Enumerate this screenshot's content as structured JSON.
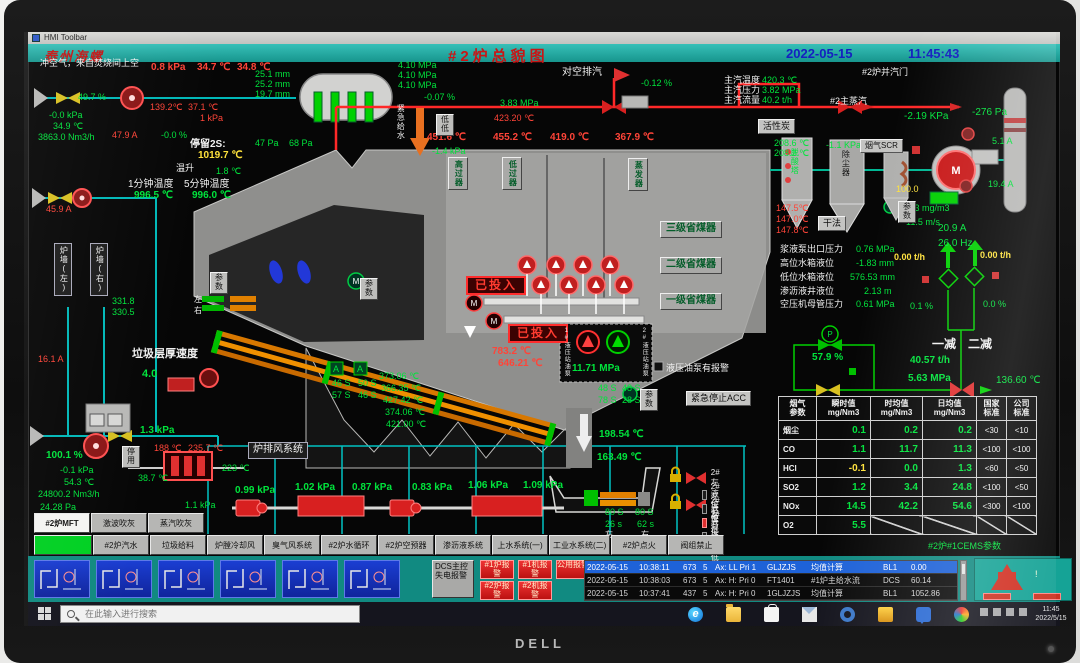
{
  "colors": {
    "green": "#00e43c",
    "red": "#ff4438",
    "yellow": "#ffe23c",
    "teal": "#17958d",
    "blue": "#1520c0",
    "orange": "#e88a10"
  },
  "monitor": {
    "brand": "DELL"
  },
  "window": {
    "title": "HMI  Toolbar"
  },
  "header": {
    "logo": "泰州海螺",
    "title": "#2炉总貌图",
    "date": "2022-05-15",
    "time": "11:45:43"
  },
  "icons": {
    "motor_letter": "M",
    "grate_letter": "A",
    "pump_letter": "P",
    "edge_glyph": "e",
    "alarm_exclaim": "!"
  },
  "annotations": [
    {
      "n": "purge-air-label",
      "t": "冲空气，来自焚烧间上空",
      "x": 36,
      "y": 59,
      "c": "w"
    },
    {
      "n": "purge-air-pressure",
      "t": "0.8 kPa",
      "x": 147,
      "y": 63,
      "c": "r",
      "s": 10,
      "w": 1
    },
    {
      "t": "34.7 ℃",
      "x": 193,
      "y": 63,
      "c": "r",
      "s": 10,
      "w": 1
    },
    {
      "t": "34.8 ℃",
      "x": 233,
      "y": 63,
      "c": "r",
      "s": 10,
      "w": 1
    },
    {
      "n": "drum-level-1",
      "t": "25.1 mm",
      "x": 251,
      "y": 70,
      "c": "g"
    },
    {
      "n": "drum-level-2",
      "t": "25.2 mm",
      "x": 251,
      "y": 80,
      "c": "g"
    },
    {
      "n": "drum-level-3",
      "t": "19.7 mm",
      "x": 251,
      "y": 90,
      "c": "g"
    },
    {
      "t": "49.7 %",
      "x": 74,
      "y": 93,
      "c": "g"
    },
    {
      "t": "-0.0 kPa",
      "x": 45,
      "y": 111,
      "c": "g"
    },
    {
      "t": "34.9 ℃",
      "x": 49,
      "y": 122,
      "c": "g"
    },
    {
      "t": "3863.0 Nm3/h",
      "x": 34,
      "y": 133,
      "c": "g"
    },
    {
      "t": "139.2℃",
      "x": 146,
      "y": 103,
      "c": "r"
    },
    {
      "t": "37.1 ℃",
      "x": 184,
      "y": 103,
      "c": "r"
    },
    {
      "t": "1 kPa",
      "x": 196,
      "y": 114,
      "c": "r"
    },
    {
      "t": "47.9 A",
      "x": 108,
      "y": 131,
      "c": "r"
    },
    {
      "t": "-0.0 %",
      "x": 157,
      "y": 131,
      "c": "g"
    },
    {
      "n": "residence-label",
      "t": "停留2S:",
      "x": 186,
      "y": 140,
      "c": "w",
      "s": 10,
      "w": 1
    },
    {
      "n": "residence-temp",
      "t": "1019.7 ℃",
      "x": 194,
      "y": 151,
      "c": "y",
      "s": 10,
      "w": 1
    },
    {
      "t": "温升",
      "x": 172,
      "y": 164,
      "c": "w"
    },
    {
      "t": "1.8 ℃",
      "x": 212,
      "y": 167,
      "c": "g"
    },
    {
      "t": "1分钟温度",
      "x": 124,
      "y": 180,
      "c": "w",
      "s": 10
    },
    {
      "t": "5分钟温度",
      "x": 180,
      "y": 180,
      "c": "w",
      "s": 10
    },
    {
      "t": "996.5 ℃",
      "x": 130,
      "y": 191,
      "c": "g",
      "s": 10,
      "w": 1
    },
    {
      "t": "996.0 ℃",
      "x": 188,
      "y": 191,
      "c": "g",
      "s": 10,
      "w": 1
    },
    {
      "t": "45.9 A",
      "x": 42,
      "y": 205,
      "c": "r"
    },
    {
      "t": "16.1 A",
      "x": 34,
      "y": 355,
      "c": "r"
    },
    {
      "t": "331.8",
      "x": 108,
      "y": 297,
      "c": "g"
    },
    {
      "t": "330.5",
      "x": 108,
      "y": 308,
      "c": "g"
    },
    {
      "t": "左",
      "x": 190,
      "y": 296,
      "c": "w",
      "s": 8
    },
    {
      "t": "右",
      "x": 190,
      "y": 307,
      "c": "w",
      "s": 8
    },
    {
      "n": "drum-pressure-1",
      "t": "4.10 MPa",
      "x": 394,
      "y": 61,
      "c": "g"
    },
    {
      "t": "4.10 MPa",
      "x": 394,
      "y": 71,
      "c": "g"
    },
    {
      "t": "4.10 MPa",
      "x": 394,
      "y": 81,
      "c": "g"
    },
    {
      "t": "-0.07 %",
      "x": 420,
      "y": 93,
      "c": "g"
    },
    {
      "t": "3.83 MPa",
      "x": 496,
      "y": 99,
      "c": "g"
    },
    {
      "t": "423.20 ℃",
      "x": 490,
      "y": 114,
      "c": "r"
    },
    {
      "n": "vent-label",
      "t": "对空排汽",
      "x": 558,
      "y": 68,
      "c": "w",
      "s": 10
    },
    {
      "t": "-0.12 %",
      "x": 637,
      "y": 79,
      "c": "g"
    },
    {
      "t": "主汽温度",
      "x": 720,
      "y": 76,
      "c": "w"
    },
    {
      "t": "主汽压力",
      "x": 720,
      "y": 86,
      "c": "w"
    },
    {
      "t": "主汽流量",
      "x": 720,
      "y": 96,
      "c": "w"
    },
    {
      "n": "main-steam-temp",
      "t": "420.3 ℃",
      "x": 758,
      "y": 76,
      "c": "g"
    },
    {
      "n": "main-steam-pressure",
      "t": "3.82 MPa",
      "x": 758,
      "y": 86,
      "c": "g"
    },
    {
      "n": "main-steam-flow",
      "t": "40.2 t/h",
      "x": 758,
      "y": 96,
      "c": "g"
    },
    {
      "t": "#2主蒸汽",
      "x": 826,
      "y": 97,
      "c": "w"
    },
    {
      "t": "#2炉并汽门",
      "x": 858,
      "y": 68,
      "c": "w"
    },
    {
      "t": "-2.19 KPa",
      "x": 900,
      "y": 112,
      "c": "g",
      "s": 10
    },
    {
      "t": "-276 Pa",
      "x": 968,
      "y": 108,
      "c": "g",
      "s": 10
    },
    {
      "t": "47 Pa",
      "x": 251,
      "y": 139,
      "c": "g"
    },
    {
      "t": "68 Pa",
      "x": 285,
      "y": 139,
      "c": "g"
    },
    {
      "t": "451.6 ℃",
      "x": 423,
      "y": 133,
      "c": "r",
      "s": 10,
      "w": 1
    },
    {
      "t": "-1.4 kPa",
      "x": 428,
      "y": 147,
      "c": "g"
    },
    {
      "t": "455.2 ℃",
      "x": 489,
      "y": 133,
      "c": "r",
      "s": 10,
      "w": 1
    },
    {
      "t": "419.0 ℃",
      "x": 546,
      "y": 133,
      "c": "r",
      "s": 10,
      "w": 1
    },
    {
      "t": "367.9 ℃",
      "x": 611,
      "y": 133,
      "c": "r",
      "s": 10,
      "w": 1
    },
    {
      "n": "emergency-feedwater",
      "t": "紧急给水",
      "x": 392,
      "y": 104,
      "c": "w",
      "v": 1,
      "s": 8
    },
    {
      "t": "208.6 ℃",
      "x": 770,
      "y": 139,
      "c": "g"
    },
    {
      "t": "208.2 ℃",
      "x": 770,
      "y": 149,
      "c": "g"
    },
    {
      "t": "-1.1 KPa",
      "x": 822,
      "y": 141,
      "c": "g"
    },
    {
      "t": "147.5℃",
      "x": 772,
      "y": 204,
      "c": "r"
    },
    {
      "t": "147.0℃",
      "x": 772,
      "y": 215,
      "c": "r"
    },
    {
      "t": "147.8℃",
      "x": 772,
      "y": 226,
      "c": "r"
    },
    {
      "t": "93.3 mg/m3",
      "x": 898,
      "y": 204,
      "c": "g"
    },
    {
      "t": "11.5 m/s",
      "x": 902,
      "y": 218,
      "c": "g"
    },
    {
      "t": "100.0",
      "x": 892,
      "y": 185,
      "c": "y"
    },
    {
      "t": "20.9 A",
      "x": 934,
      "y": 224,
      "c": "g",
      "s": 10
    },
    {
      "t": "26.0 Hz",
      "x": 934,
      "y": 239,
      "c": "g",
      "s": 10
    },
    {
      "t": "5.1 A",
      "x": 988,
      "y": 137,
      "c": "g"
    },
    {
      "t": "19.4 A",
      "x": 984,
      "y": 180,
      "c": "g"
    },
    {
      "t": "浆液泵出口压力",
      "x": 776,
      "y": 245,
      "c": "w"
    },
    {
      "t": "0.76 MPa",
      "x": 852,
      "y": 245,
      "c": "g"
    },
    {
      "t": "高位水箱液位",
      "x": 776,
      "y": 259,
      "c": "w"
    },
    {
      "t": "-1.83 mm",
      "x": 852,
      "y": 259,
      "c": "g"
    },
    {
      "t": "低位水箱液位",
      "x": 776,
      "y": 273,
      "c": "w"
    },
    {
      "t": "576.53 mm",
      "x": 846,
      "y": 273,
      "c": "g"
    },
    {
      "t": "渗沥液井液位",
      "x": 776,
      "y": 287,
      "c": "w"
    },
    {
      "t": "2.13 m",
      "x": 860,
      "y": 287,
      "c": "g"
    },
    {
      "t": "空压机母管压力",
      "x": 776,
      "y": 300,
      "c": "w"
    },
    {
      "t": "0.61 MPa",
      "x": 852,
      "y": 300,
      "c": "g"
    },
    {
      "t": "0.00 t/h",
      "x": 890,
      "y": 253,
      "c": "y",
      "w": 1
    },
    {
      "t": "0.00 t/h",
      "x": 976,
      "y": 251,
      "c": "y",
      "w": 1
    },
    {
      "t": "0.1 %",
      "x": 906,
      "y": 302,
      "c": "g"
    },
    {
      "t": "0.0 %",
      "x": 979,
      "y": 300,
      "c": "g"
    },
    {
      "t": "一减",
      "x": 928,
      "y": 338,
      "c": "w",
      "s": 12,
      "w": 1
    },
    {
      "t": "二减",
      "x": 964,
      "y": 338,
      "c": "w",
      "s": 12,
      "w": 1
    },
    {
      "t": "57.9 %",
      "x": 808,
      "y": 353,
      "c": "g",
      "s": 10,
      "w": 1
    },
    {
      "t": "40.57 t/h",
      "x": 906,
      "y": 356,
      "c": "g",
      "s": 10,
      "w": 1
    },
    {
      "t": "5.63 MPa",
      "x": 904,
      "y": 374,
      "c": "g",
      "s": 10,
      "w": 1
    },
    {
      "t": "136.60 ℃",
      "x": 992,
      "y": 376,
      "c": "g",
      "s": 10
    },
    {
      "t": "783.2 ℃",
      "x": 488,
      "y": 347,
      "c": "r",
      "s": 10,
      "w": 1
    },
    {
      "t": "646.21 ℃",
      "x": 494,
      "y": 359,
      "c": "r",
      "s": 10,
      "w": 1
    },
    {
      "t": "11.71 MPa",
      "x": 568,
      "y": 364,
      "c": "g",
      "s": 10,
      "w": 1
    },
    {
      "n": "hyd-alarm-label",
      "t": "液压油泵有报警",
      "x": 662,
      "y": 364,
      "c": "w"
    },
    {
      "n": "waste-layer-label",
      "t": "垃圾层厚速度",
      "x": 128,
      "y": 349,
      "c": "w",
      "s": 11,
      "w": 1
    },
    {
      "t": "4.0",
      "x": 138,
      "y": 369,
      "c": "g",
      "s": 11,
      "w": 1
    },
    {
      "t": "373.06 ℃",
      "x": 375,
      "y": 372,
      "c": "g"
    },
    {
      "t": "366.35 ℃",
      "x": 377,
      "y": 384,
      "c": "g"
    },
    {
      "t": "427.42 ℃",
      "x": 379,
      "y": 396,
      "c": "g"
    },
    {
      "t": "374.06 ℃",
      "x": 381,
      "y": 408,
      "c": "g"
    },
    {
      "t": "421.00 ℃",
      "x": 382,
      "y": 420,
      "c": "g"
    },
    {
      "t": "46 S",
      "x": 328,
      "y": 379,
      "c": "g"
    },
    {
      "t": "50 S",
      "x": 354,
      "y": 379,
      "c": "g"
    },
    {
      "t": "57 S",
      "x": 328,
      "y": 391,
      "c": "g"
    },
    {
      "t": "46 S",
      "x": 354,
      "y": 391,
      "c": "g"
    },
    {
      "t": "48 S",
      "x": 594,
      "y": 384,
      "c": "g"
    },
    {
      "t": "48 S",
      "x": 618,
      "y": 384,
      "c": "g"
    },
    {
      "t": "78 S",
      "x": 594,
      "y": 396,
      "c": "g"
    },
    {
      "t": "28 S",
      "x": 618,
      "y": 396,
      "c": "g"
    },
    {
      "t": "1.3 kPa",
      "x": 136,
      "y": 426,
      "c": "g",
      "s": 10,
      "w": 1
    },
    {
      "t": "188 ℃",
      "x": 150,
      "y": 444,
      "c": "r"
    },
    {
      "t": "235.7 ℃",
      "x": 184,
      "y": 444,
      "c": "r"
    },
    {
      "t": "38.7 ℃",
      "x": 134,
      "y": 474,
      "c": "g"
    },
    {
      "t": "223 ℃",
      "x": 218,
      "y": 464,
      "c": "g"
    },
    {
      "t": "100.1 %",
      "x": 42,
      "y": 451,
      "c": "g",
      "s": 10,
      "w": 1
    },
    {
      "t": "-0.1 kPa",
      "x": 56,
      "y": 466,
      "c": "g"
    },
    {
      "t": "54.3 ℃",
      "x": 60,
      "y": 478,
      "c": "g"
    },
    {
      "t": "24800.2 Nm3/h",
      "x": 34,
      "y": 490,
      "c": "g"
    },
    {
      "t": "24.28 Pa",
      "x": 36,
      "y": 503,
      "c": "g"
    },
    {
      "t": "0.99 kPa",
      "x": 231,
      "y": 486,
      "c": "g",
      "s": 10,
      "w": 1
    },
    {
      "t": "1.02 kPa",
      "x": 291,
      "y": 483,
      "c": "g",
      "s": 10,
      "w": 1
    },
    {
      "t": "0.87 kPa",
      "x": 348,
      "y": 483,
      "c": "g",
      "s": 10,
      "w": 1
    },
    {
      "t": "0.83 kPa",
      "x": 408,
      "y": 483,
      "c": "g",
      "s": 10,
      "w": 1
    },
    {
      "t": "1.06 kPa",
      "x": 464,
      "y": 481,
      "c": "g",
      "s": 10,
      "w": 1
    },
    {
      "t": "1.09 kPa",
      "x": 519,
      "y": 481,
      "c": "g",
      "s": 10,
      "w": 1
    },
    {
      "t": "1.1 kPa",
      "x": 181,
      "y": 501,
      "c": "g"
    },
    {
      "t": "198.54 ℃",
      "x": 595,
      "y": 430,
      "c": "g",
      "s": 10,
      "w": 1
    },
    {
      "t": "163.49 ℃",
      "x": 593,
      "y": 453,
      "c": "g",
      "s": 10,
      "w": 1
    },
    {
      "t": "80 S",
      "x": 601,
      "y": 508,
      "c": "g"
    },
    {
      "t": "80 S",
      "x": 631,
      "y": 508,
      "c": "g"
    },
    {
      "t": "26 s",
      "x": 601,
      "y": 520,
      "c": "g"
    },
    {
      "t": "62 s",
      "x": 633,
      "y": 520,
      "c": "g"
    },
    {
      "t": "左",
      "x": 601,
      "y": 531,
      "c": "w",
      "s": 8
    },
    {
      "t": "右",
      "x": 637,
      "y": 531,
      "c": "w",
      "s": 8
    },
    {
      "n": "cems-caption",
      "t": "#2炉#1CEMS参数",
      "x": 924,
      "y": 542,
      "c": "g"
    },
    {
      "n": "committed-1",
      "t": "已投入",
      "x": 462,
      "y": 276,
      "bx": "red"
    },
    {
      "n": "committed-2",
      "t": "已投入",
      "x": 504,
      "y": 324,
      "bx": "red"
    },
    {
      "n": "activated-carbon-box",
      "t": "活性炭",
      "x": 754,
      "y": 119,
      "bx": "2"
    },
    {
      "n": "scr-box",
      "t": "烟气SCR",
      "x": 856,
      "y": 139,
      "bx": "2",
      "s": 8
    },
    {
      "n": "dry-method-box",
      "t": "干法",
      "x": 814,
      "y": 216,
      "bx": "2"
    },
    {
      "n": "economizer-3",
      "t": "三级省煤器",
      "x": 656,
      "y": 221,
      "bx": "3",
      "s": 10
    },
    {
      "n": "economizer-2",
      "t": "二级省煤器",
      "x": 656,
      "y": 257,
      "bx": "3",
      "s": 10
    },
    {
      "n": "economizer-1",
      "t": "一级省煤器",
      "x": 656,
      "y": 293,
      "bx": "3",
      "s": 10
    },
    {
      "n": "grate-fan-system-box",
      "t": "炉排风系统",
      "x": 244,
      "y": 442,
      "bx": "1",
      "s": 10
    },
    {
      "n": "acc-stop-box",
      "t": "紧急停止ACC",
      "x": 682,
      "y": 391,
      "bx": "2"
    },
    {
      "n": "furnace-wall-left",
      "t": "炉墙(左)",
      "x": 50,
      "y": 243,
      "bx": "1",
      "v": 1,
      "s": 8
    },
    {
      "n": "furnace-wall-right",
      "t": "炉墙(右)",
      "x": 86,
      "y": 243,
      "bx": "1",
      "v": 1,
      "s": 8
    },
    {
      "n": "hp-superheater",
      "t": "高过器",
      "x": 444,
      "y": 157,
      "bx": "3",
      "v": 1,
      "s": 8
    },
    {
      "n": "lp-superheater",
      "t": "低过器",
      "x": 498,
      "y": 157,
      "bx": "3",
      "v": 1,
      "s": 8
    },
    {
      "n": "evaporator",
      "t": "蒸发器",
      "x": 624,
      "y": 158,
      "bx": "3",
      "v": 1,
      "s": 8
    },
    {
      "n": "deacid-tower-label",
      "t": "脱酸塔",
      "x": 786,
      "y": 148,
      "c": "g",
      "v": 1,
      "s": 8
    },
    {
      "n": "baghouse-label",
      "t": "除尘器",
      "x": 837,
      "y": 150,
      "c": "k",
      "v": 1,
      "s": 8
    },
    {
      "n": "hyd-pump-1-label",
      "t": "1#液压站油泵",
      "x": 559,
      "y": 328,
      "c": "w",
      "v": 1,
      "s": 6
    },
    {
      "n": "hyd-pump-2-label",
      "t": "2#液压站油泵",
      "x": 637,
      "y": 328,
      "c": "w",
      "v": 1,
      "s": 6
    }
  ],
  "small_buttons": [
    {
      "n": "param-button-1",
      "t": "参数",
      "x": 206,
      "y": 272
    },
    {
      "n": "param-button-2",
      "t": "参数",
      "x": 356,
      "y": 278
    },
    {
      "n": "param-button-3",
      "t": "参数",
      "x": 636,
      "y": 389
    },
    {
      "n": "param-button-4",
      "t": "参数",
      "x": 894,
      "y": 201
    },
    {
      "n": "disabled-button",
      "t": "停用",
      "x": 118,
      "y": 446
    },
    {
      "n": "lowlow-button",
      "t": "低低",
      "x": 432,
      "y": 114
    }
  ],
  "menus": {
    "row1": [
      {
        "t": "#2炉MFT",
        "active": true
      },
      {
        "t": "激波吹灰"
      },
      {
        "t": "蒸汽吹灰"
      }
    ],
    "row2": [
      {
        "t": "",
        "green": true
      },
      {
        "t": "#2炉汽水"
      },
      {
        "t": "垃圾给料"
      },
      {
        "t": "炉膛冷却风"
      },
      {
        "t": "臭气风系统"
      },
      {
        "t": "#2炉水循环"
      },
      {
        "t": "#2炉空预器"
      },
      {
        "t": "渗沥液系统"
      },
      {
        "t": "上水系统(一)"
      },
      {
        "t": "工业水系统(二)"
      },
      {
        "t": "#2炉点火"
      },
      {
        "t": "阀组禁止"
      }
    ]
  },
  "level_switches": [
    {
      "t": "2#左液位高",
      "on": false
    },
    {
      "t": "2#左液位低",
      "on": false
    },
    {
      "t": "2#右液位高",
      "on": true
    },
    {
      "t": "2#右液位低",
      "on": false
    }
  ],
  "emissions": {
    "headers": [
      "烟气|参数",
      "瞬时值|mg/Nm3",
      "时均值|mg/Nm3",
      "日均值|mg/Nm3",
      "国家|标准",
      "公司|标准"
    ],
    "rows": [
      [
        "烟尘",
        "0.1",
        "0.2",
        "0.2",
        "<30",
        "<10"
      ],
      [
        "CO",
        "1.1",
        "11.7",
        "11.3",
        "<100",
        "<100"
      ],
      [
        "HCl",
        "-0.1",
        "0.0",
        "1.3",
        "<60",
        "<50"
      ],
      [
        "SO2",
        "1.2",
        "3.4",
        "24.8",
        "<100",
        "<50"
      ],
      [
        "NOx",
        "14.5",
        "42.2",
        "54.6",
        "<300",
        "<100"
      ],
      [
        "O2",
        "5.5",
        "/",
        "/",
        "/",
        "/"
      ]
    ]
  },
  "alarm_strip": {
    "thumbnails": [
      "screen-thumbnail-1",
      "screen-thumbnail-2",
      "screen-thumbnail-3",
      "screen-thumbnail-4",
      "screen-thumbnail-5",
      "screen-thumbnail-6"
    ],
    "dcs_button": "DCS主控失电报警",
    "alarm_buttons": [
      {
        "t": "#1炉报警",
        "x": 452,
        "y": 4
      },
      {
        "t": "#1机报警",
        "x": 490,
        "y": 4
      },
      {
        "t": "公用报警",
        "x": 528,
        "y": 4
      },
      {
        "t": "#2炉报警",
        "x": 452,
        "y": 25
      },
      {
        "t": "#2机报警",
        "x": 490,
        "y": 25
      }
    ],
    "rows": [
      {
        "sel": true,
        "cols": [
          "2022-05-15",
          "10:38:11",
          "673",
          "5",
          "Ax: LL Pri 1",
          "GLJZJS",
          "均值计算",
          "BL1",
          "0.00"
        ]
      },
      {
        "sel": false,
        "cols": [
          "2022-05-15",
          "10:38:03",
          "673",
          "5",
          "Ax: H: Pri 0",
          "FT1401",
          "#1炉主给水流",
          "DCS",
          "60.14"
        ]
      },
      {
        "sel": false,
        "cols": [
          "2022-05-15",
          "10:37:41",
          "437",
          "5",
          "Ax: H: Pri 0",
          "1GLJZJS",
          "均值计算",
          "BL1",
          "1052.86"
        ]
      }
    ]
  },
  "taskbar": {
    "search_placeholder": "在此输入进行搜索",
    "icons": [
      "edge",
      "folder",
      "store",
      "mail",
      "settings",
      "files",
      "chat",
      "colors"
    ],
    "clock_time": "11:45",
    "clock_date": "2022/5/15"
  }
}
